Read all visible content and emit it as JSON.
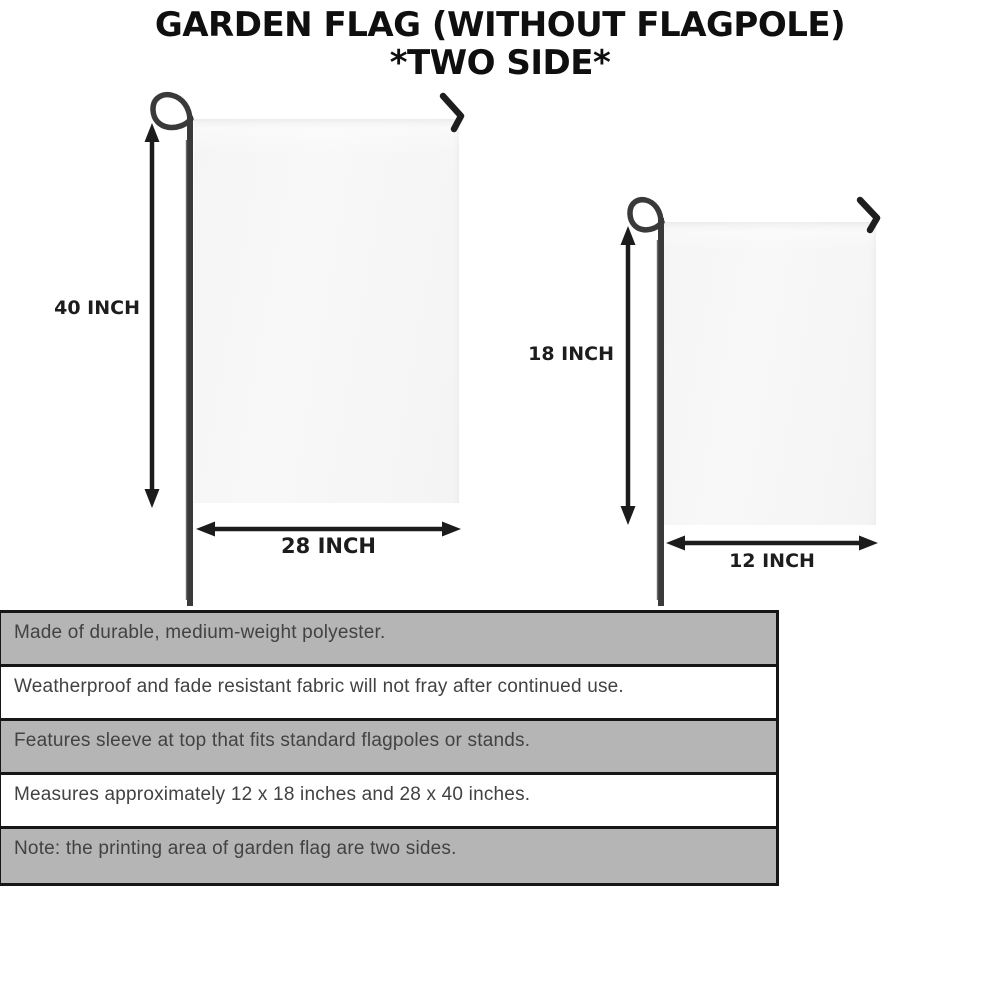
{
  "title": {
    "line1": "GARDEN FLAG (WITHOUT FLAGPOLE)",
    "line2": "*TWO SIDE*"
  },
  "diagram": {
    "large_flag": {
      "height_label": "40 INCH",
      "width_label": "28 INCH"
    },
    "small_flag": {
      "height_label": "18 INCH",
      "width_label": "12 INCH"
    }
  },
  "specs": {
    "rows": [
      {
        "text": "Made of durable, medium-weight polyester.",
        "shaded": true
      },
      {
        "text": "Weatherproof and fade resistant fabric will not fray after continued use.",
        "shaded": false
      },
      {
        "text": "Features sleeve at top that fits standard flagpoles or stands.",
        "shaded": true
      },
      {
        "text": "Measures approximately 12 x 18 inches and 28 x 40 inches.",
        "shaded": false
      },
      {
        "text": "Note: the printing area of garden flag are two sides.",
        "shaded": true
      }
    ]
  },
  "colors": {
    "title_text": "#0f0f0f",
    "arrow": "#1c1c1c",
    "pole": "#3a3a3a",
    "hook": "#1e1e1e",
    "flag_fill": "#f6f6f6",
    "table_border": "#161616",
    "row_shaded_bg": "#b5b5b5",
    "row_plain_bg": "#ffffff",
    "row_text": "#424242",
    "page_bg": "#ffffff"
  }
}
